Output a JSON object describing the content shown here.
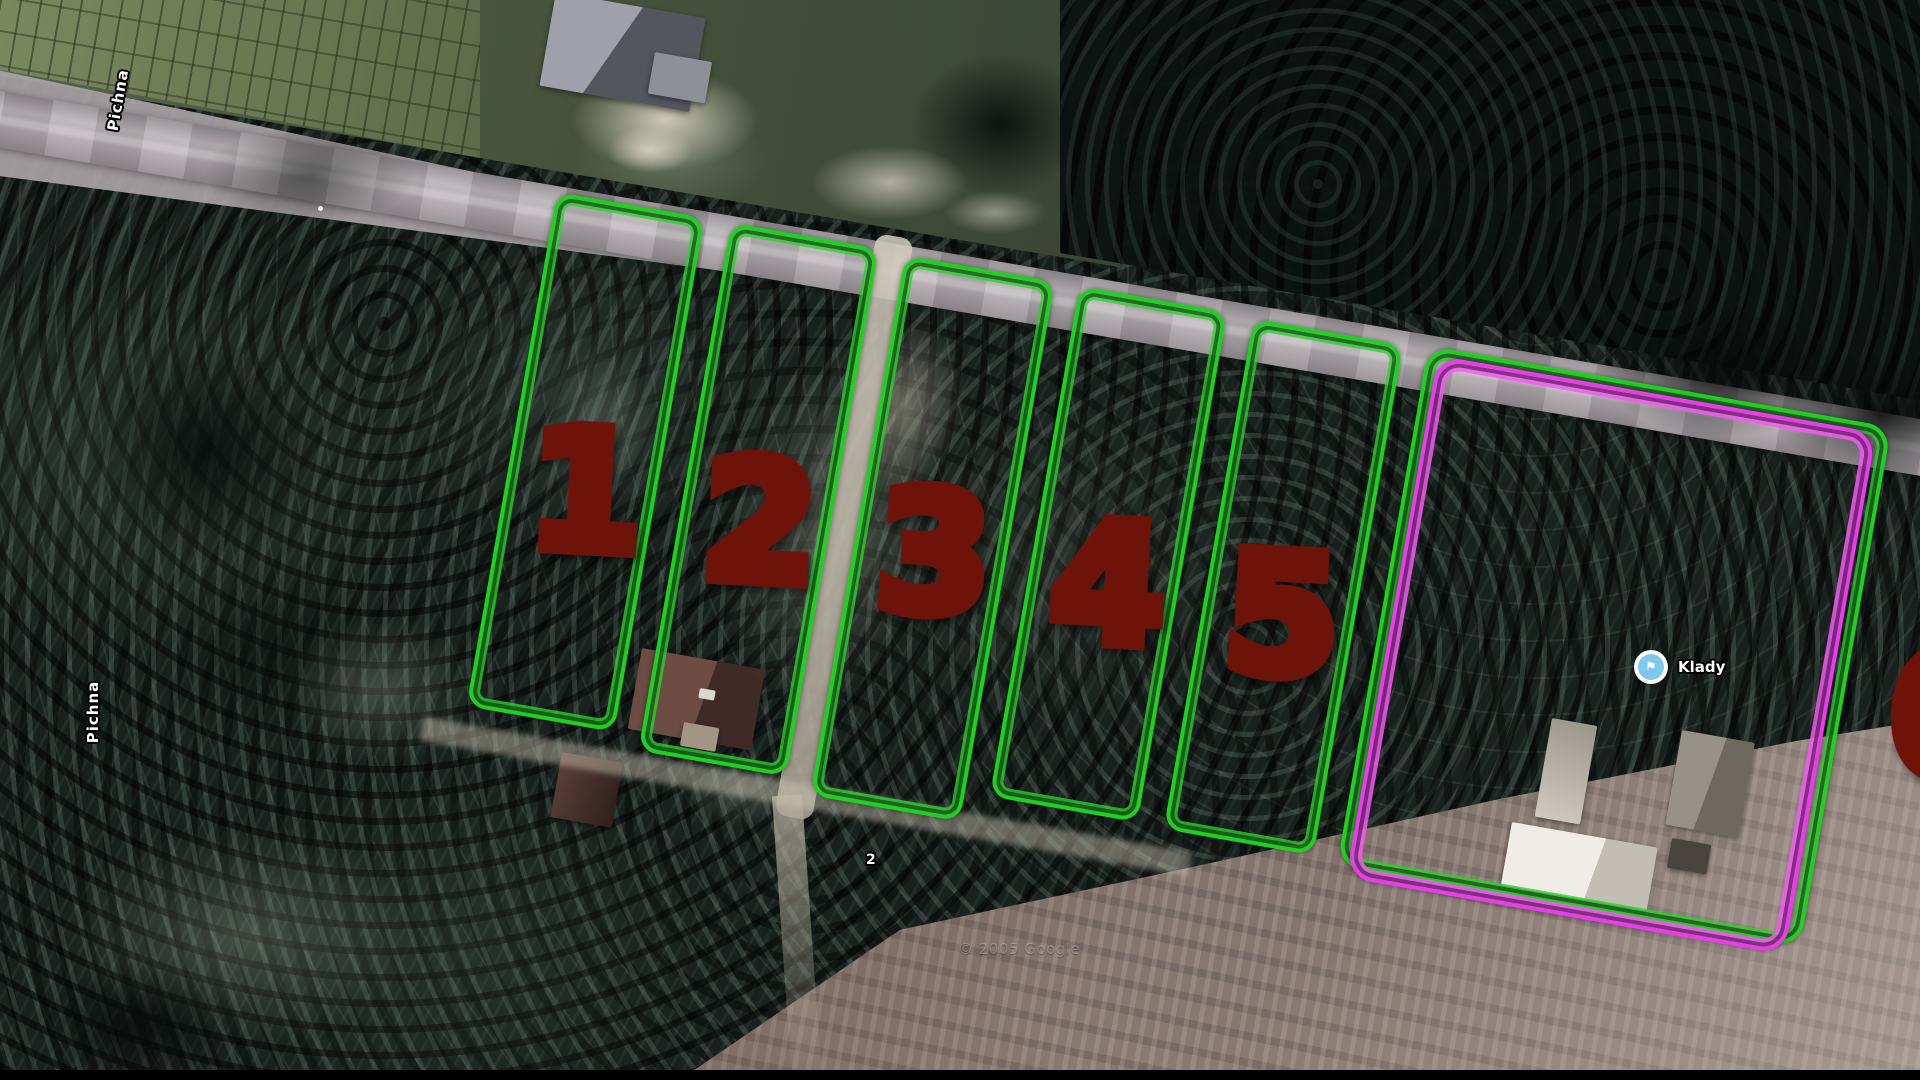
{
  "map_overlay": {
    "street_labels": [
      {
        "text": "Pichna"
      },
      {
        "text": "Pichna"
      }
    ],
    "place_marker": {
      "name": "Klady"
    },
    "house_number": "2",
    "watermark": "© 2005 Google",
    "plot_numbers": [
      "1",
      "2",
      "3",
      "4",
      "5",
      "6"
    ],
    "colors": {
      "plot_outline_green": "#1fd11f",
      "highlight_outline_magenta": "#ea3cea",
      "number_gradient_top": "#fce33f",
      "number_gradient_bottom": "#ec6f26",
      "number_outline": "#6e1309",
      "road_gray": "#aba4a8",
      "poi_icon_blue": "#7cc9ec"
    }
  }
}
